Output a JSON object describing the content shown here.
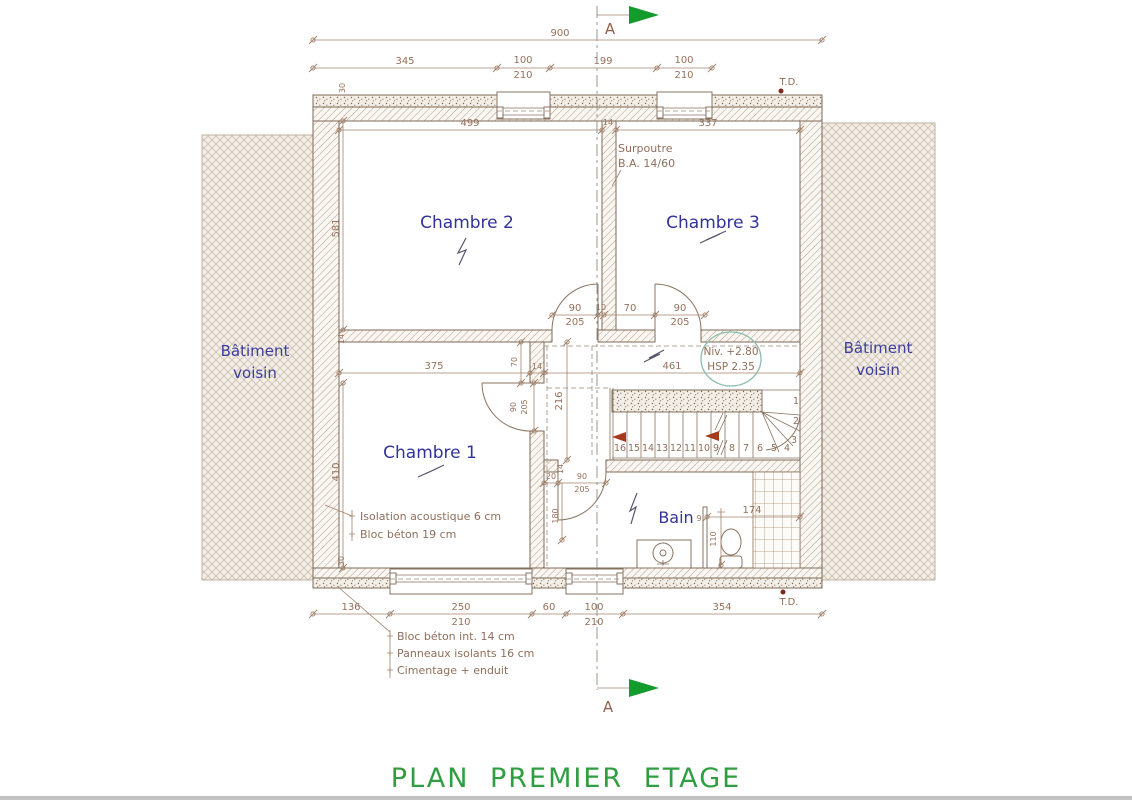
{
  "title": "PLAN PREMIER ETAGE",
  "section_label": "A",
  "td_label": "T.D.",
  "neighbor": {
    "line1": "Bâtiment",
    "line2": "voisin"
  },
  "rooms": {
    "chambre2": "Chambre 2",
    "chambre3": "Chambre 3",
    "chambre1": "Chambre 1",
    "bain": "Bain"
  },
  "annotations": {
    "surpoutre_l1": "Surpoutre",
    "surpoutre_l2": "B.A. 14/60",
    "niv_l1": "Niv. +2.80",
    "niv_l2": "HSP 2.35",
    "wall_left_l1": "Isolation acoustique 6 cm",
    "wall_left_l2": "Bloc béton 19 cm",
    "wall_bottom_l1": "Bloc béton int. 14 cm",
    "wall_bottom_l2": "Panneaux isolants 16 cm",
    "wall_bottom_l3": "Cimentage + enduit"
  },
  "dims": {
    "overall": "900",
    "t345": "345",
    "t100a": "100",
    "t210a": "210",
    "t199": "199",
    "t100b": "100",
    "t210b": "210",
    "w499": "499",
    "w14": "14",
    "w337": "337",
    "v30t": "30",
    "v581": "581",
    "v14": "14",
    "v410": "410",
    "v30b": "30",
    "d90a": "90",
    "d205a": "205",
    "d10": "10",
    "d70": "70",
    "d90b": "90",
    "d205b": "205",
    "w375": "375",
    "w14b": "14",
    "w461": "461",
    "v70": "70",
    "v216": "216",
    "d90c": "90",
    "d205c": "205",
    "b20": "20",
    "b14": "14",
    "d90d": "90",
    "d205d": "205",
    "v180": "180",
    "s9": "9",
    "s174": "174",
    "s110": "110",
    "g136": "136",
    "g250": "250",
    "g210a": "210",
    "g60": "60",
    "g100": "100",
    "g210b": "210",
    "g354": "354"
  },
  "stairs": {
    "treads": [
      "16",
      "15",
      "14",
      "13",
      "12",
      "11",
      "10",
      "9",
      "8",
      "7",
      "6",
      "5",
      "4",
      "3",
      "2",
      "1"
    ]
  },
  "colors": {
    "title_green": "#2f9e41",
    "arrow_green": "#149b2e",
    "room_blue": "#32329b",
    "dim_brown": "#96705a",
    "stair_arrow_red": "#a63a1c",
    "level_circle_teal": "#8cbcae"
  }
}
